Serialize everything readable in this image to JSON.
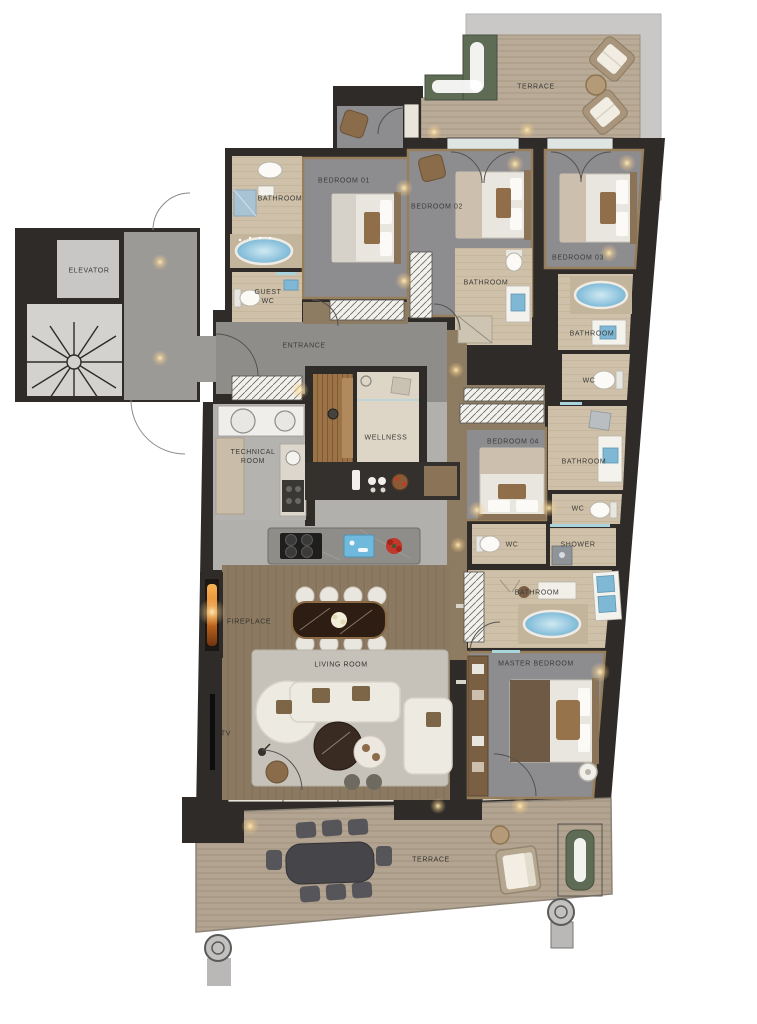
{
  "title": "Penthouse apartment floor plan",
  "labels": {
    "terrace_top": "TERRACE",
    "bathroom_1": "BATHROOM",
    "bedroom_01": "BEDROOM 01",
    "bedroom_02": "BEDROOM 02",
    "bedroom_03": "BEDROOM 03",
    "elevator": "ELEVATOR",
    "guest_wc": "GUEST WC",
    "entrance": "ENTRANCE",
    "bathroom_2": "BATHROOM",
    "bathroom_3": "BATHROOM",
    "wc_1": "WC",
    "technical_room": "TECHNICAL ROOM",
    "wellness": "WELLNESS",
    "bedroom_04": "BEDROOM 04",
    "bathroom_4": "BATHROOM",
    "wc_2": "WC",
    "wc_3": "WC",
    "shower": "SHOWER",
    "bathroom_5": "BATHROOM",
    "fireplace": "FIREPLACE",
    "living_room": "LIVING ROOM",
    "tv": "TV",
    "master_bedroom": "MASTER BEDROOM",
    "terrace_bottom": "TERRACE"
  },
  "palette": {
    "wall": "#2e2b28",
    "carpet": "#8d8c8f",
    "wood_floor": "#8b7a61",
    "bath_floor": "#cfc1a9",
    "deck": "#b9ab97",
    "concrete": "#c9c8c6",
    "stone": "#8f8d8a",
    "kitchen_stone": "#b2b0ad",
    "water": "#79b7d6",
    "timber_trim": "#977f5c",
    "flame_orange": "#e07a22",
    "planter_green": "#5e6b55",
    "sofa_cream": "#edeae2",
    "accent_pillow": "#7d6547"
  }
}
